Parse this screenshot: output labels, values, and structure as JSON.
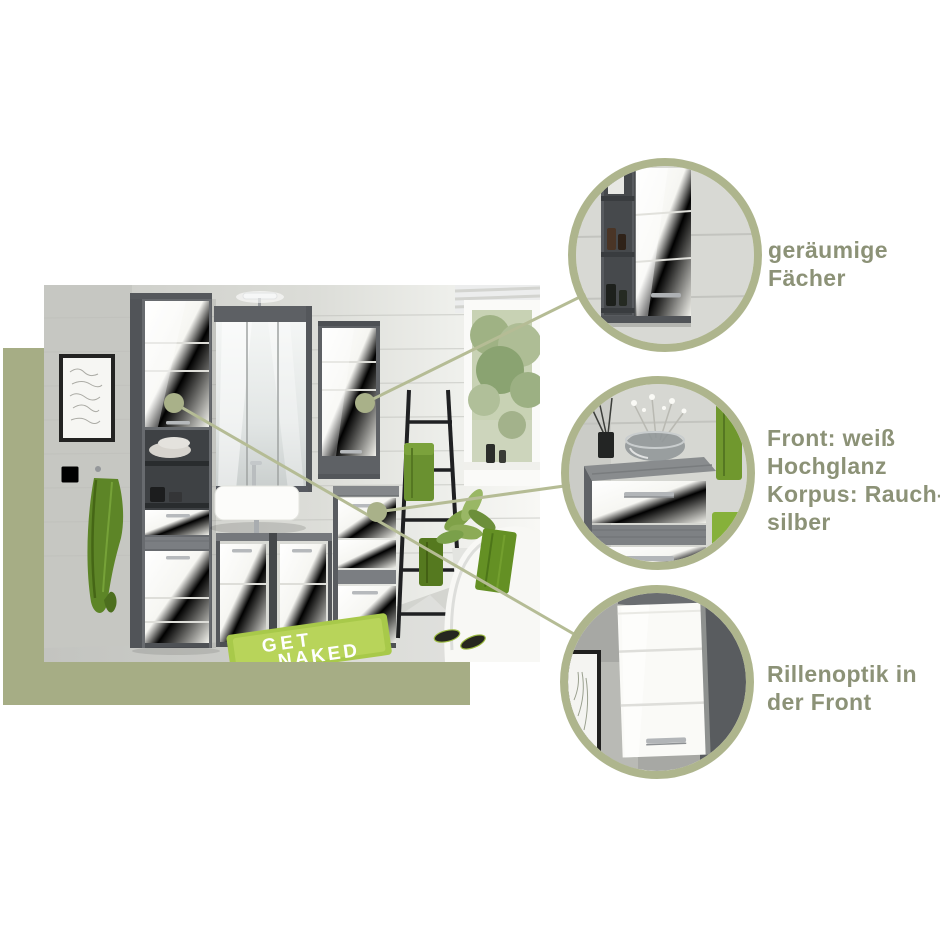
{
  "palette": {
    "olive_bg": "#a6ad85",
    "olive_ring": "#aeb58d",
    "olive_line": "#b5bc95",
    "olive_dot": "#a9b189",
    "label_text": "#8c9277",
    "carcass_smoke_silver": "#64676b",
    "front_white_gloss": "#f5f5f2",
    "rug_green": "#a8c94a"
  },
  "photo": {
    "rug_line1": "GET",
    "rug_line2": "NAKED"
  },
  "callouts": [
    {
      "id": "callout-1",
      "label": "geräumige Fächer",
      "lines": [
        "geräumige",
        "Fächer"
      ]
    },
    {
      "id": "callout-2",
      "label": "Front: weiß Hochglanz Korpus: Rauchsilber",
      "lines": [
        "Front: weiß",
        "Hochglanz",
        "Korpus: Rauch-",
        "silber"
      ]
    },
    {
      "id": "callout-3",
      "label": "Rillenoptik in der Front",
      "lines": [
        "Rillenoptik in",
        "der Front"
      ]
    }
  ]
}
